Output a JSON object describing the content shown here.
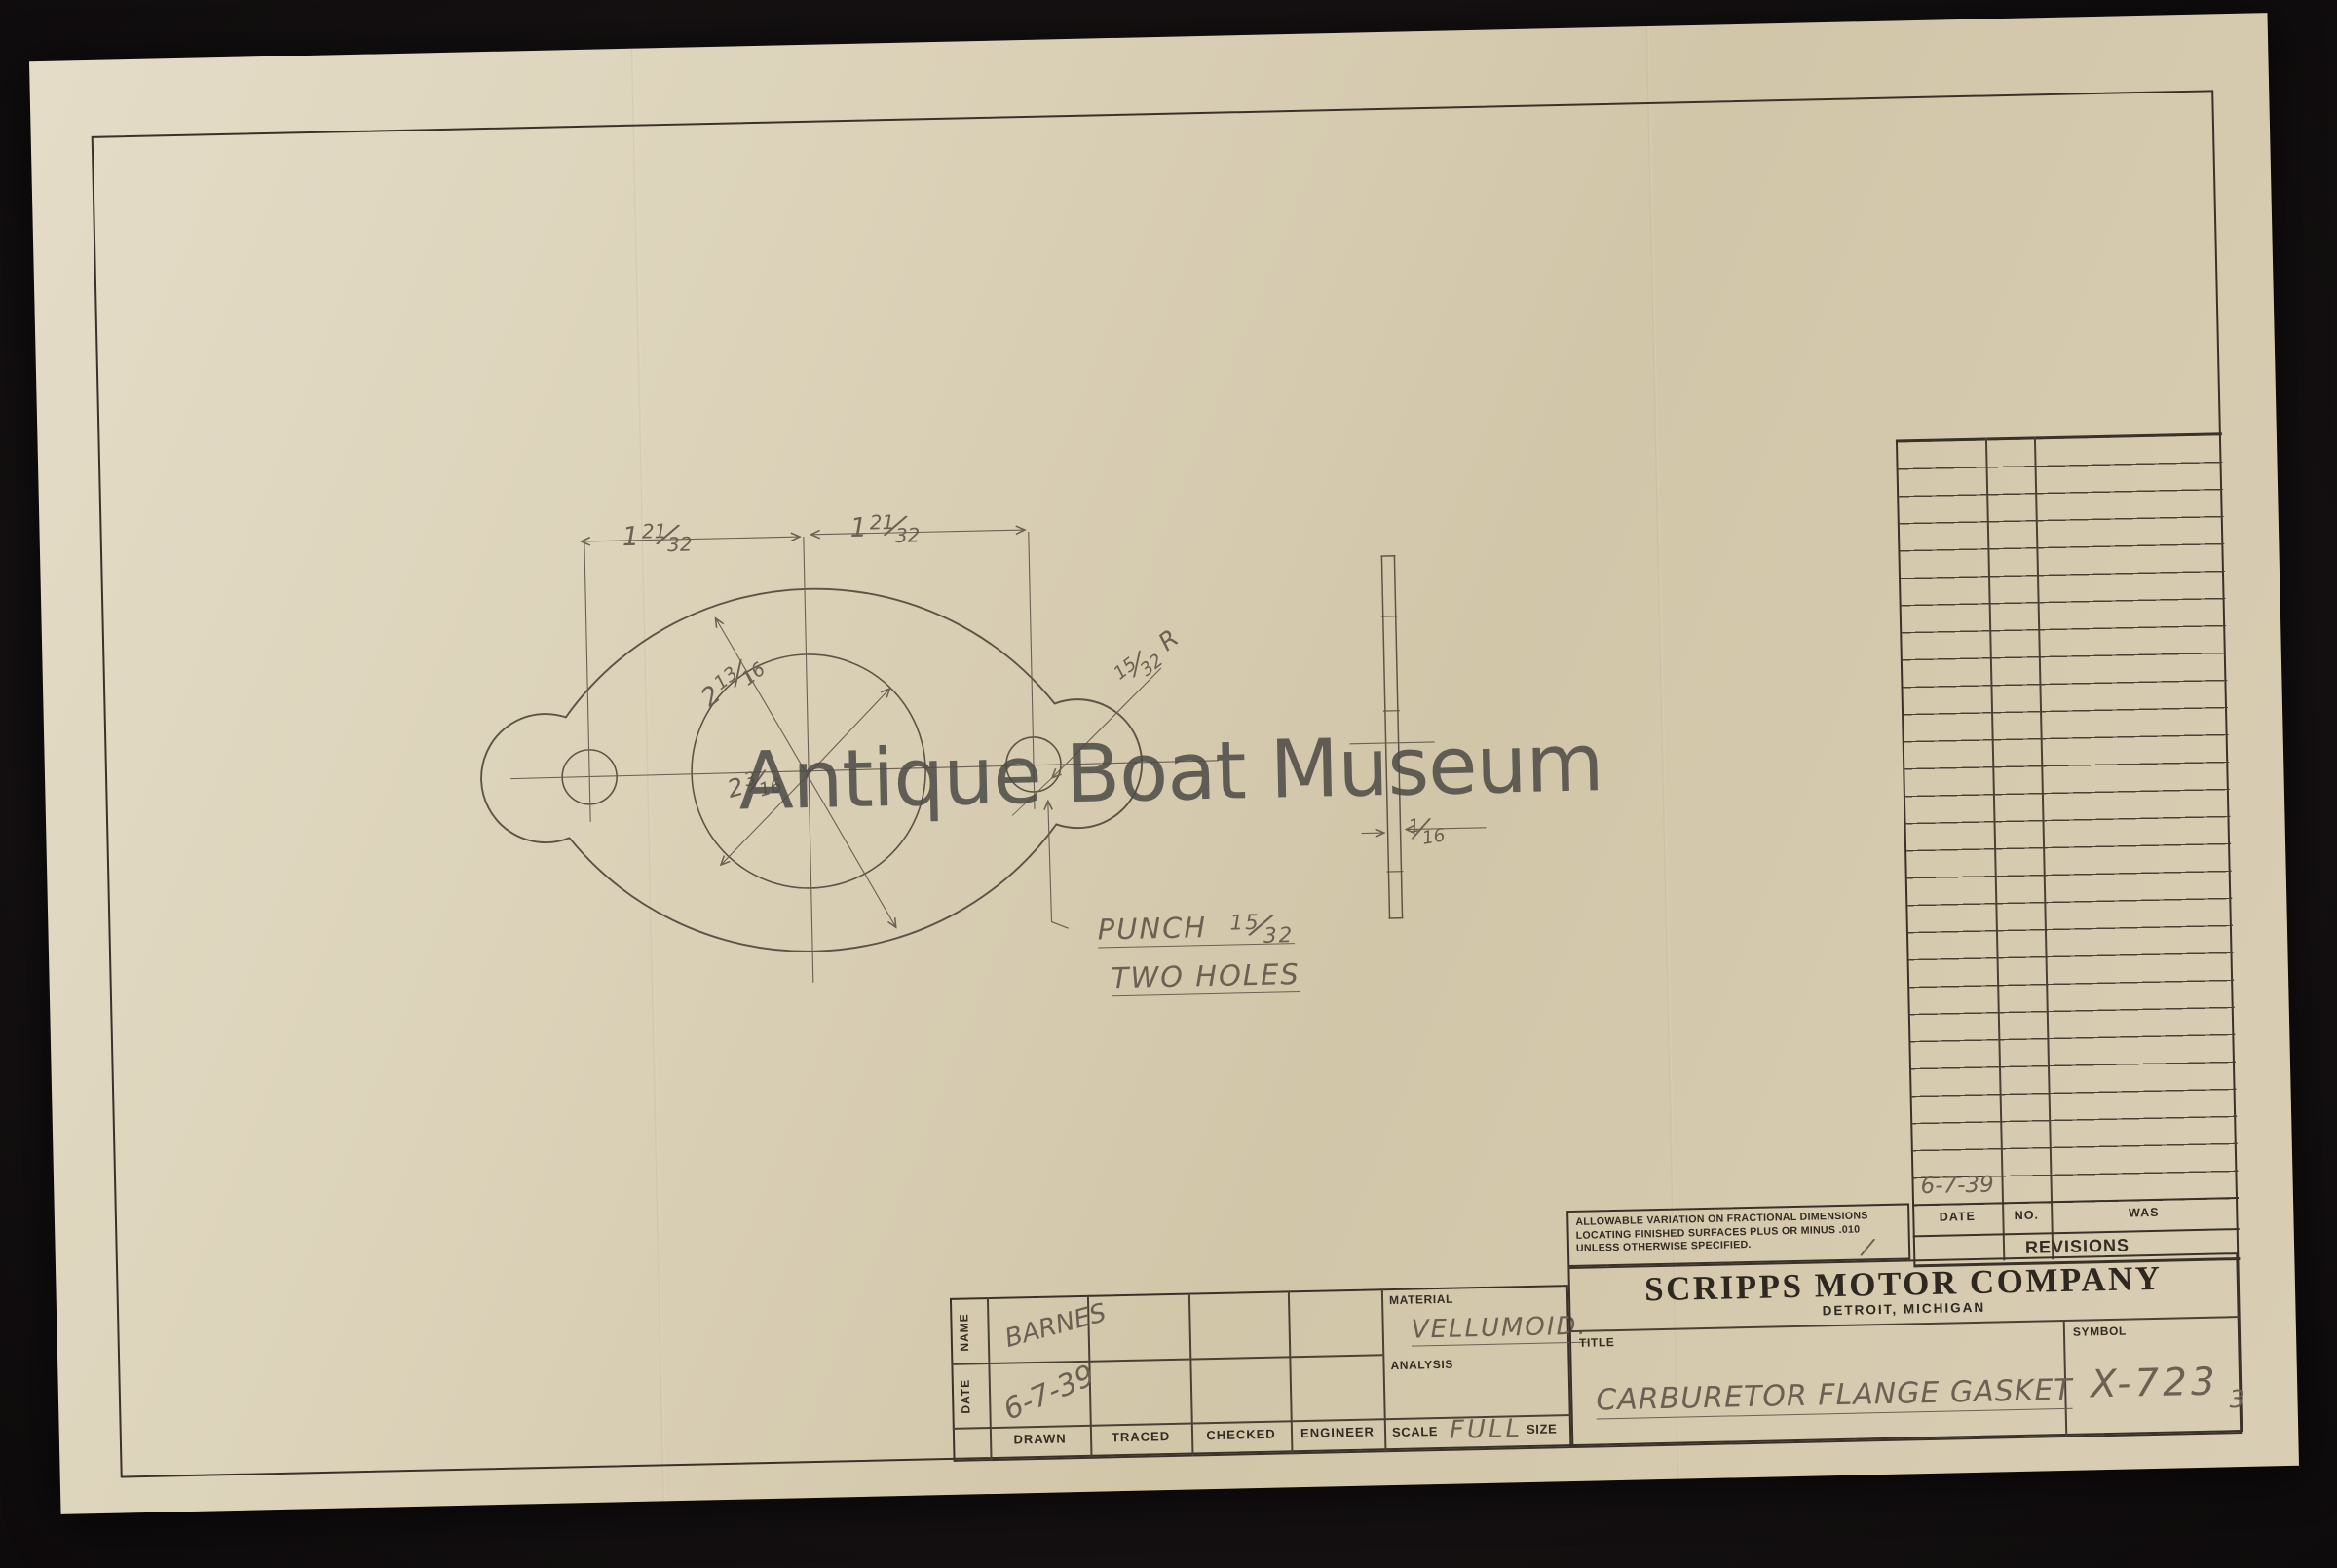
{
  "watermark": "Antique Boat Museum",
  "page_number": "3",
  "company": {
    "name": "SCRIPPS MOTOR COMPANY",
    "location": "DETROIT, MICHIGAN"
  },
  "tolerance_note": "ALLOWABLE VARIATION ON FRACTIONAL DIMENSIONS LOCATING FINISHED SURFACES PLUS OR MINUS .010 UNLESS OTHERWISE SPECIFIED.",
  "title_block": {
    "name_label": "NAME",
    "date_label": "DATE",
    "name_value": "BARNES",
    "date_value": "6-7-39",
    "columns": [
      "DRAWN",
      "TRACED",
      "CHECKED",
      "ENGINEER"
    ],
    "material_label": "MATERIAL",
    "material_value": "VELLUMOID.",
    "analysis_label": "ANALYSIS",
    "scale_label": "SCALE",
    "scale_value": "FULL",
    "size_label": "SIZE",
    "title_label": "TITLE",
    "title_value": "CARBURETOR FLANGE GASKET",
    "symbol_label": "SYMBOL",
    "symbol_value": "X-723"
  },
  "revisions": {
    "header": "REVISIONS",
    "columns": [
      "DATE",
      "NO.",
      "WAS"
    ],
    "entry_date": "6-7-39"
  },
  "drawing": {
    "dim_left": {
      "w": "1",
      "n": "21",
      "d": "32"
    },
    "dim_right": {
      "w": "1",
      "n": "21",
      "d": "32"
    },
    "dim_outer": {
      "w": "2",
      "n": "13",
      "d": "16"
    },
    "dim_bore": {
      "w": "2",
      "n": "3",
      "d": "16"
    },
    "dim_radius": {
      "n": "15",
      "d": "32",
      "suffix": "R"
    },
    "dim_thickness": {
      "n": "1",
      "d": "16"
    },
    "note_punch": "PUNCH",
    "note_punch_frac": {
      "n": "15",
      "d": "32"
    },
    "note_holes": "TWO HOLES"
  },
  "colors": {
    "paper": "#d8cdb3",
    "ink_printed": "#332c23",
    "pencil": "#6b6052",
    "background": "#171213"
  }
}
